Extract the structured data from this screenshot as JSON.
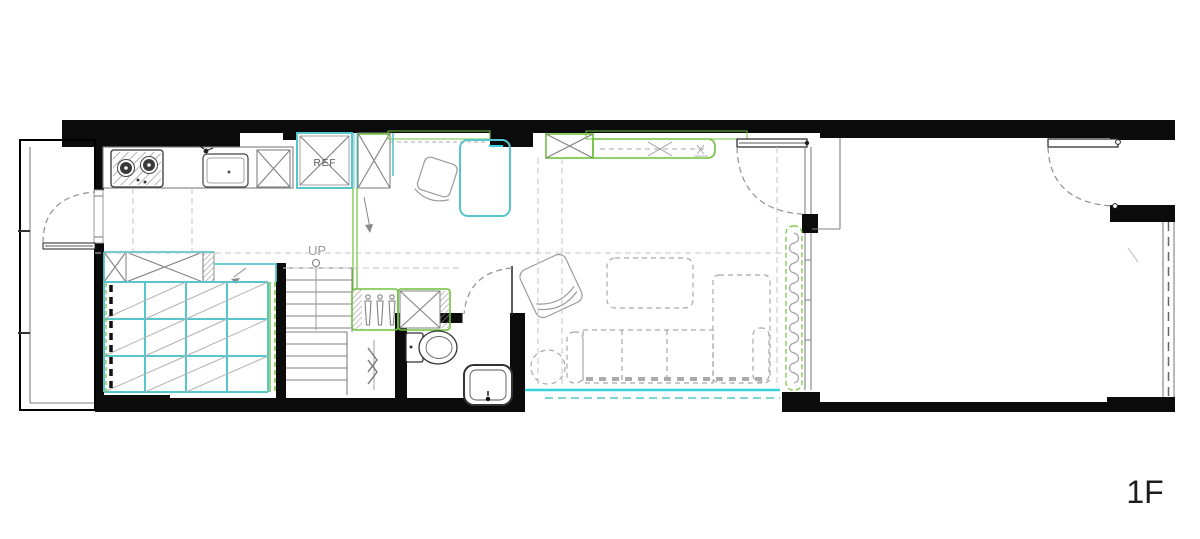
{
  "plan": {
    "labels": {
      "ref": "REF",
      "up": "UP",
      "floor": "1F"
    },
    "colors": {
      "wall": "#0b0b0b",
      "line_gray": "#8a8a8a",
      "dash_gray": "#c4c4c4",
      "cyan": "#57c6cc",
      "cyan_bright": "#34d4e0",
      "green": "#6fc23d"
    }
  }
}
